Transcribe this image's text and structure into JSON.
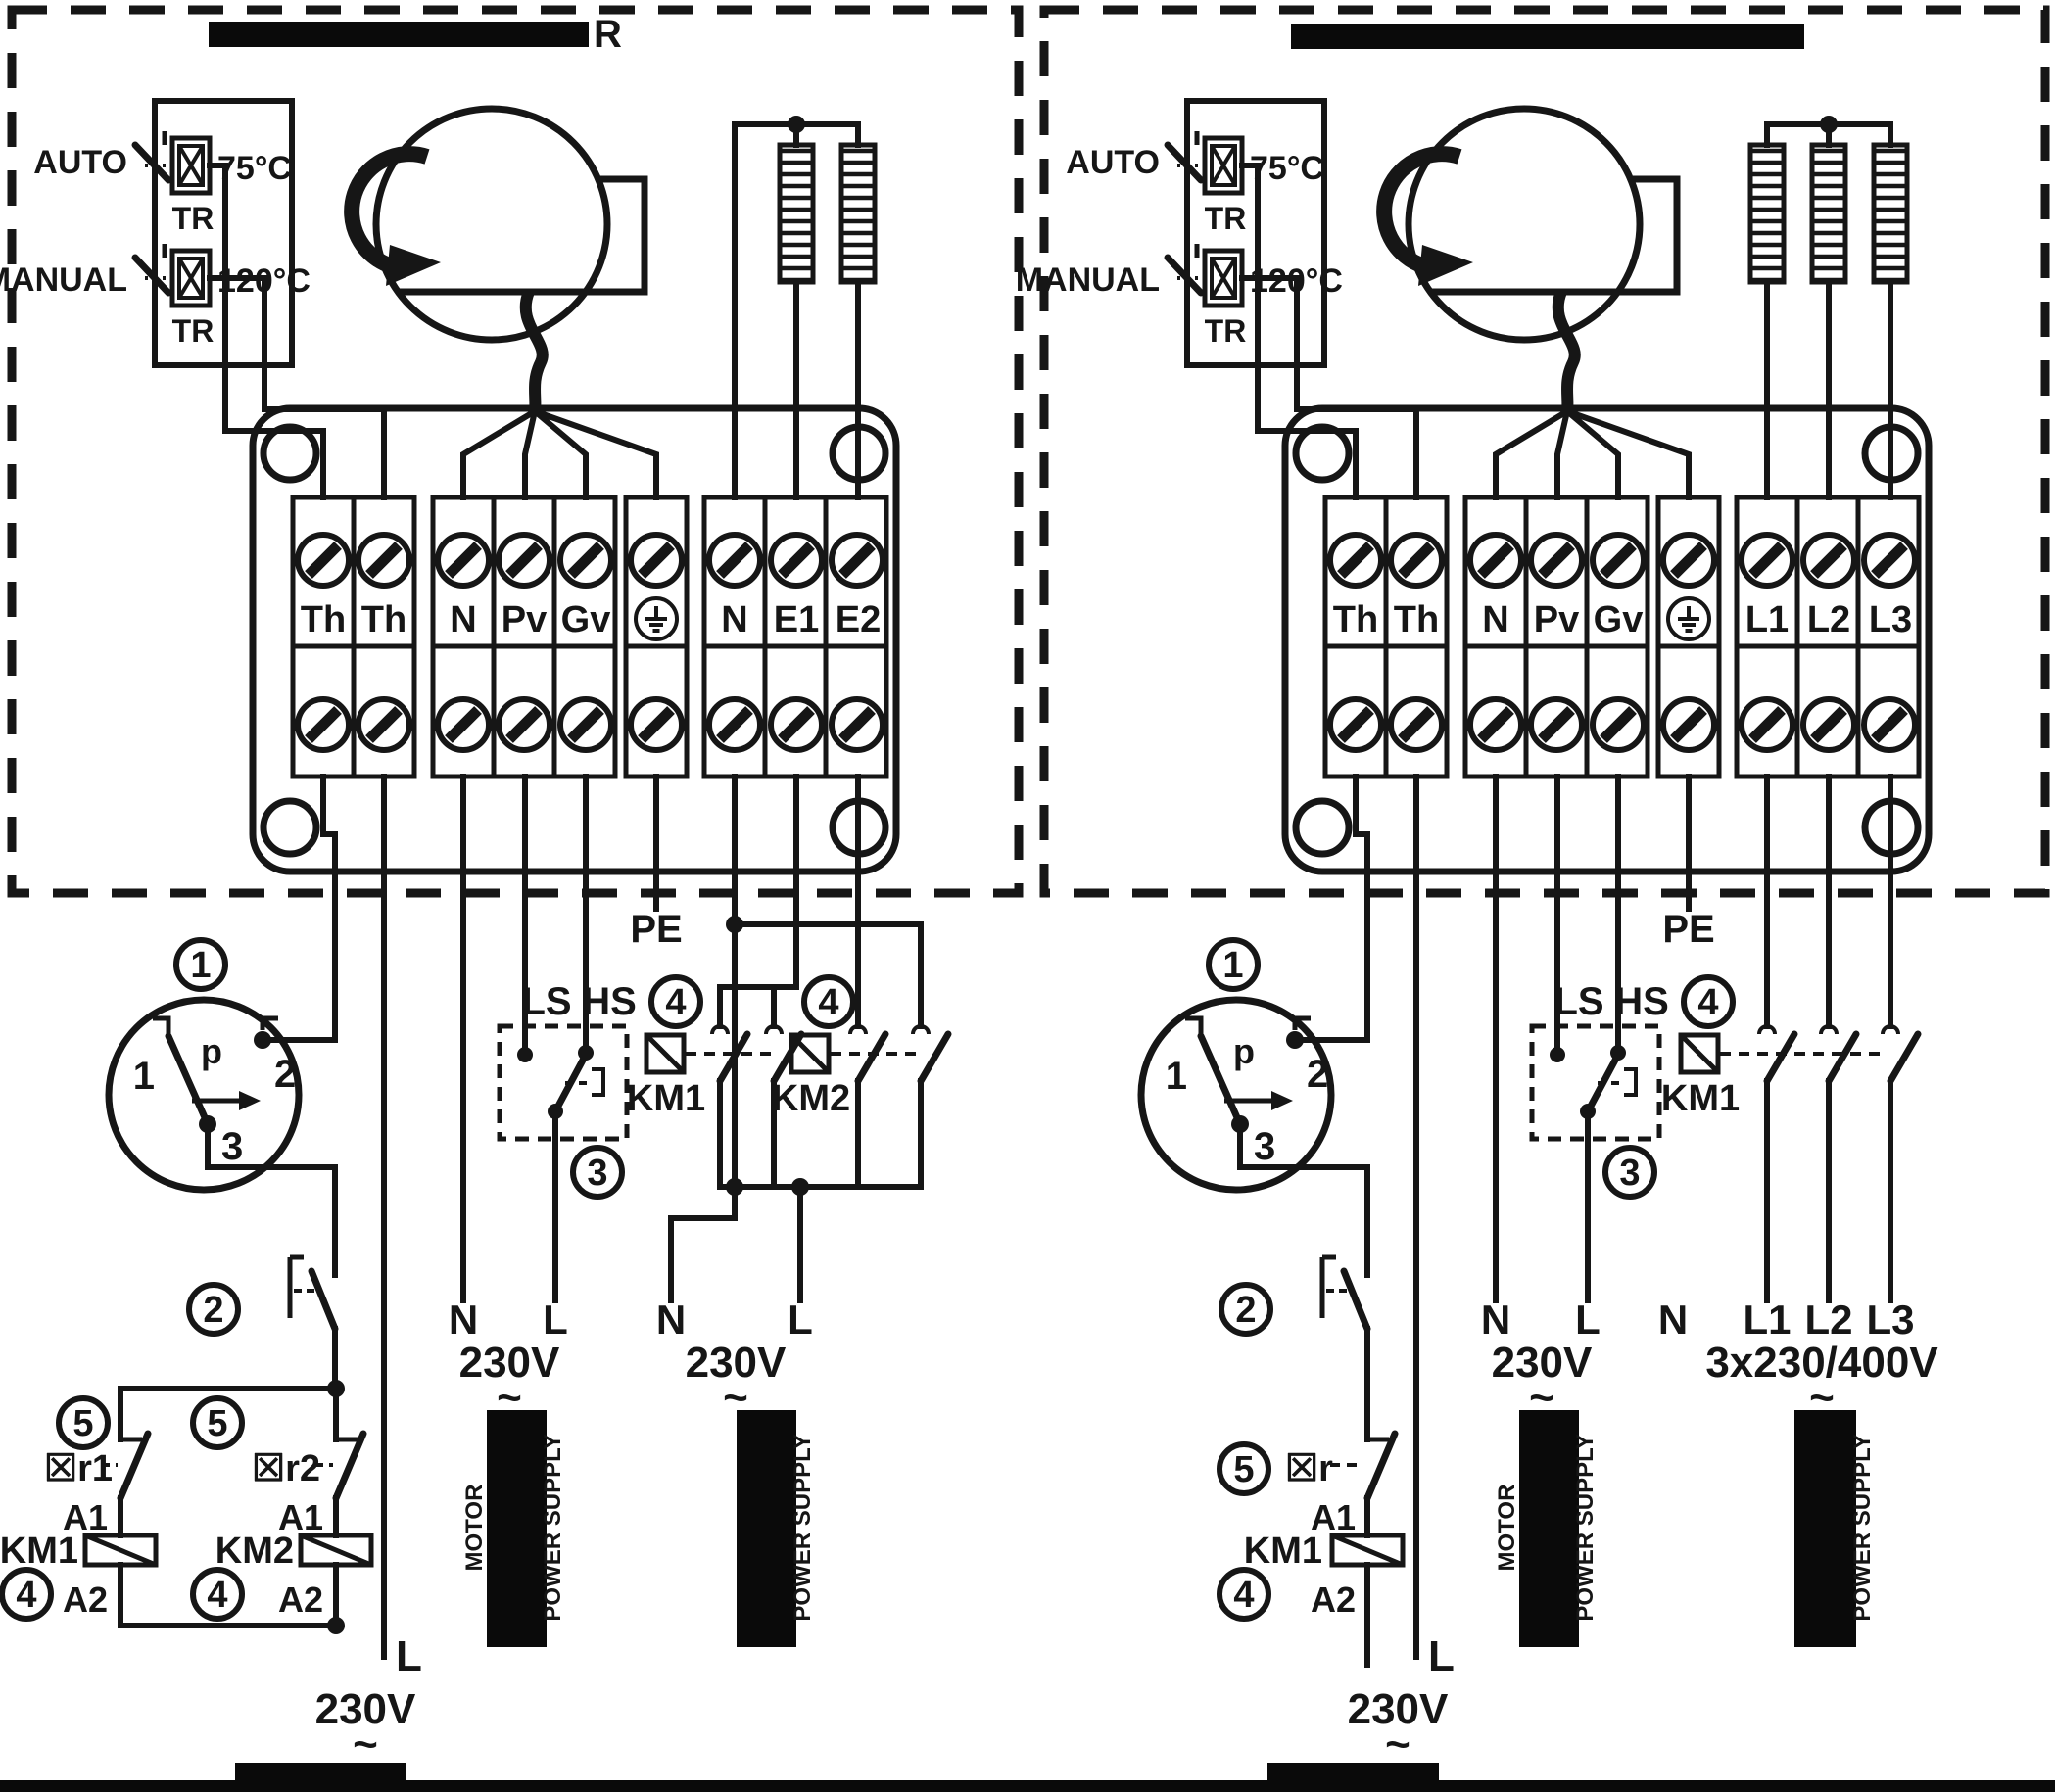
{
  "shared": {
    "auto_label": "AUTO",
    "manual_label": "MANUAL",
    "tr_label": "TR",
    "temp_auto": "75°C",
    "temp_manual": "120°C",
    "pe_label": "PE",
    "ls_label": "LS",
    "hs_label": "HS",
    "pressure_p": "p",
    "ps_terminal_1": "1",
    "ps_terminal_2": "2",
    "ps_terminal_3": "3",
    "circled_1": "1",
    "circled_2": "2",
    "circled_3": "3",
    "circled_4": "4",
    "circled_5": "5",
    "km1_label": "KM1",
    "km2_label": "KM2",
    "a1_label": "A1",
    "a2_label": "A2",
    "n_label": "N",
    "l_label": "L",
    "v230": "230V",
    "ac_tilde": "~",
    "motor_cord_text": "MOTOR",
    "power_supply_text": "POWER SUPPLY",
    "colors": {
      "line": "#161616",
      "redaction": "#0a0a0a",
      "background": "#ffffff"
    }
  },
  "left_panel": {
    "title_visible_letter": "R",
    "terminals": [
      "Th",
      "Th",
      "N",
      "Pv",
      "Gv",
      "N",
      "E1",
      "E2"
    ],
    "relay1_nc": "☒r1",
    "relay2_nc": "☒r2"
  },
  "right_panel": {
    "terminals": [
      "Th",
      "Th",
      "N",
      "Pv",
      "Gv",
      "L1",
      "L2",
      "L3"
    ],
    "relay_nc": "☒r",
    "heater_voltage": "3x230/400V",
    "heater_phase_labels": [
      "L1",
      "L2",
      "L3"
    ]
  }
}
